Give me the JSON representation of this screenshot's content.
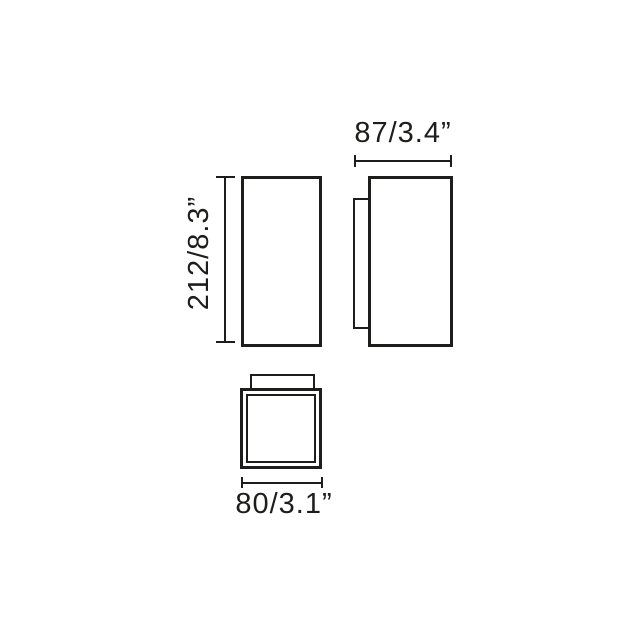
{
  "drawing": {
    "background_color": "#ffffff",
    "line_color": "#1d1d1b",
    "dimensions": {
      "height": {
        "label": "212/8.3”"
      },
      "depth": {
        "label": "87/3.4”"
      },
      "width": {
        "label": "80/3.1”"
      }
    }
  }
}
